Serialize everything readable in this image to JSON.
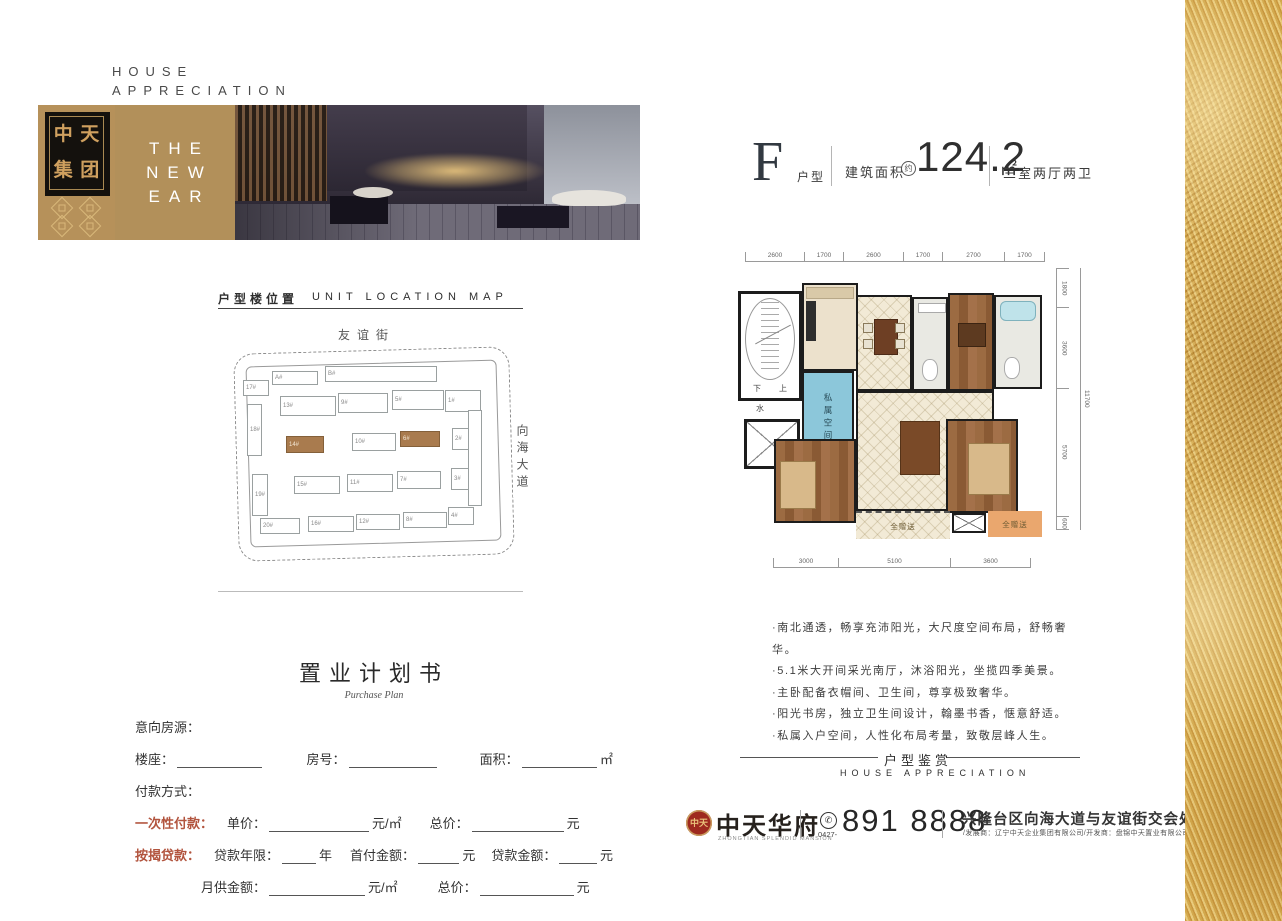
{
  "colors": {
    "brand_gold": "#b2905a",
    "seal_red": "#9e2a1f",
    "form_accent_red": "#b2543e",
    "highlight_building_brown": "#a97b4e",
    "private_space_blue": "#8cc7da",
    "balcony_orange": "#eaa76e",
    "gold_strip": "#d4a93f"
  },
  "header": {
    "house_appreciation": "HOUSE\nAPPRECIATION",
    "logo_chars": [
      "中",
      "天",
      "集",
      "团"
    ],
    "banner_lines": [
      "THE",
      "NEW",
      "EAR"
    ]
  },
  "unit_title": {
    "letter": "F",
    "type_label": "户型",
    "area_prefix": "建筑面积",
    "area_circle": "约",
    "area_value": "124.2",
    "area_unit": "㎡",
    "rooms": "三室两厅两卫"
  },
  "floor_plan": {
    "dims_top": [
      "2600",
      "1700",
      "2600",
      "1700",
      "2700",
      "1700"
    ],
    "dims_right": [
      "1800",
      "3600",
      "5700",
      "600"
    ],
    "dims_right_total": "11700",
    "dims_bottom": [
      "3000",
      "5100",
      "3600"
    ],
    "labels": {
      "down": "下",
      "up": "上",
      "water": "水",
      "private_space": "私属空间",
      "gift_left": "全赠送",
      "gift_right": "全赠送"
    }
  },
  "location_map": {
    "title_cn": "户型楼位置",
    "title_en": "UNIT LOCATION MAP",
    "street_top": "友谊街",
    "street_right": "向海大道",
    "highlighted": [
      "14#",
      "6#"
    ],
    "buildings": [
      "17#",
      "A#",
      "B#",
      "1#",
      "13#",
      "9#",
      "5#",
      "18#",
      "14#",
      "10#",
      "6#",
      "2#",
      "19#",
      "15#",
      "11#",
      "7#",
      "3#",
      "20#",
      "16#",
      "12#",
      "8#",
      "4#"
    ]
  },
  "features": [
    "·南北通透，畅享充沛阳光，大尺度空间布局，舒畅奢华。",
    "·5.1米大开间采光南厅，沐浴阳光，坐揽四季美景。",
    "·主卧配备衣帽间、卫生间，尊享极致奢华。",
    "·阳光书房，独立卫生间设计，翰墨书香，惬意舒适。",
    "·私属入户空间，人性化布局考量，致敬层峰人生。"
  ],
  "purchase_plan": {
    "title": "置业计划书",
    "subtitle": "Purchase Plan",
    "intent_label": "意向房源：",
    "building_label": "楼座：",
    "room_label": "房号：",
    "area_label": "面积：",
    "area_suffix": "㎡",
    "payment_label": "付款方式：",
    "onetime_label": "一次性付款：",
    "unit_price_label": "单价：",
    "unit_price_suffix": "元/㎡",
    "total_price_label": "总价：",
    "total_price_suffix": "元",
    "mortgage_label": "按揭贷款：",
    "loan_years_label": "贷款年限：",
    "loan_years_suffix": "年",
    "down_payment_label": "首付金额：",
    "down_payment_suffix": "元",
    "loan_amount_label": "贷款金额：",
    "loan_amount_suffix": "元",
    "monthly_label": "月供金额：",
    "monthly_suffix": "元/㎡",
    "total2_label": "总价：",
    "total2_suffix": "元"
  },
  "appreciation_divider": {
    "cn": "户型鉴赏",
    "en": "HOUSE APPRECIATION"
  },
  "footer": {
    "seal_text": "中天",
    "brand_name": "中天华府",
    "brand_sub": "ZHONGTIAN SPLENDID MANSION",
    "phone_icon": "✆",
    "phone_area": "0427-",
    "phone": "891 8888",
    "address": "兴隆台区向海大道与友谊街交会处",
    "developers": "/发展商：辽宁中天企业集团有限公司/开发商：盘锦中天置业有限公司"
  }
}
